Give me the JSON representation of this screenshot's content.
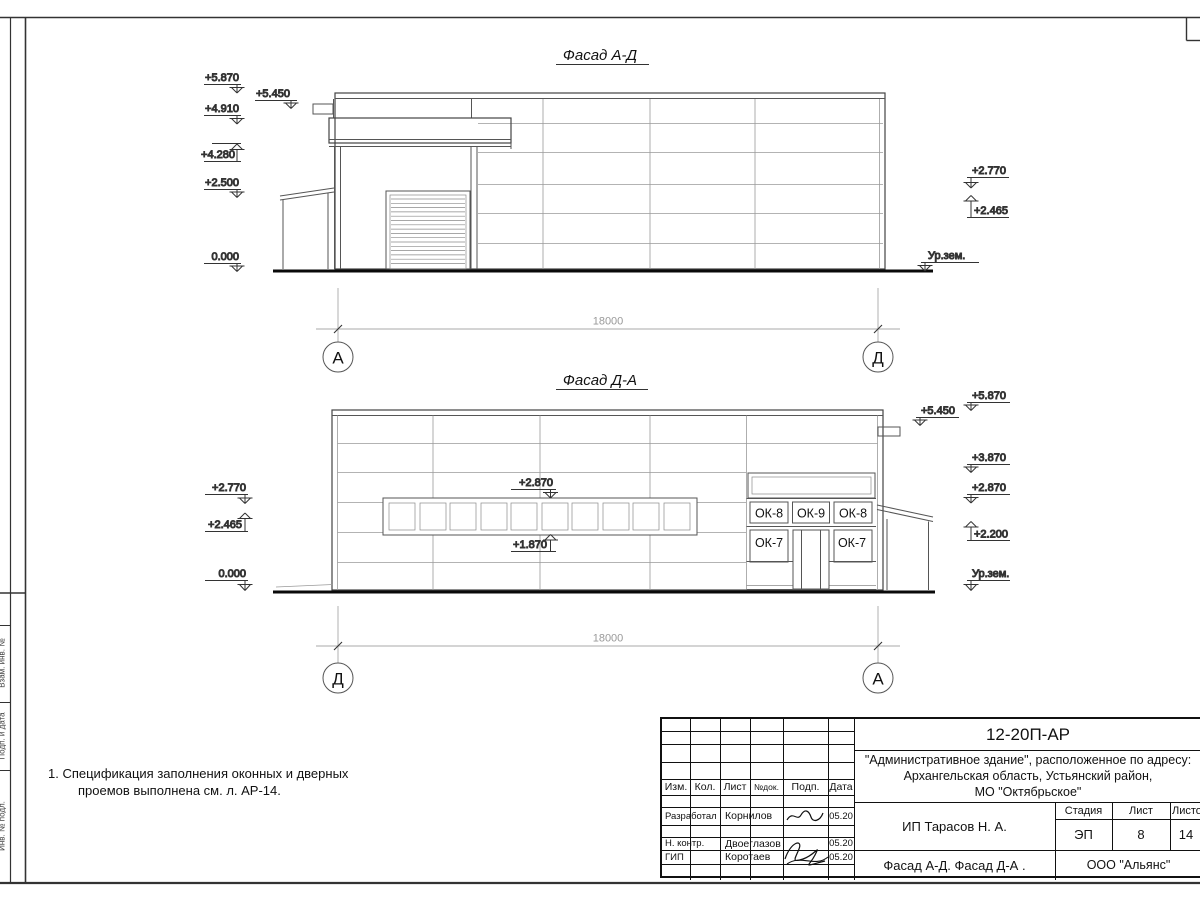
{
  "frame": {
    "side_labels": {
      "l1": "Взам. инв. №",
      "l2": "Подп. и дата",
      "l3": "Инв. № подл."
    }
  },
  "facade1": {
    "title": "Фасад А-Д",
    "marks": {
      "m5870": "+5.870",
      "m4910": "+4.910",
      "m4280": "+4.280",
      "m2500": "+2.500",
      "m0000": "0.000",
      "m5450": "+5.450",
      "m2770": "+2.770",
      "m2465": "+2.465",
      "ground": "Ур.зем."
    },
    "dim": "18000",
    "axis_left": "А",
    "axis_right": "Д"
  },
  "facade2": {
    "title": "Фасад Д-А",
    "marks": {
      "m5870": "+5.870",
      "m5450": "+5.450",
      "m3870": "+3.870",
      "m2870r": "+2.870",
      "m2200": "+2.200",
      "m2770": "+2.770",
      "m2465": "+2.465",
      "m0000": "0.000",
      "band_top": "+2.870",
      "band_bottom": "+1.870",
      "ground": "Ур.зем."
    },
    "windows": {
      "ok8a": "ОК-8",
      "ok9": "ОК-9",
      "ok8b": "ОК-8",
      "ok7a": "ОК-7",
      "ok7b": "ОК-7"
    },
    "dim": "18000",
    "axis_left": "Д",
    "axis_right": "А"
  },
  "note": {
    "line1": "1. Спецификация заполнения оконных и дверных",
    "line2": "проемов выполнена см. л. АР-14."
  },
  "titleblock": {
    "code": "12-20П-АР",
    "project": {
      "line1": "\"Административное здание\", расположенное по адресу:",
      "line2": "Архангельская область, Устьянский район,",
      "line3": "МО \"Октябрьское\""
    },
    "headers": {
      "izm": "Изм.",
      "kol": "Кол.",
      "list": "Лист",
      "ndoc": "№док.",
      "podp": "Подп.",
      "data": "Дата"
    },
    "rows": [
      {
        "role": "Разработал",
        "name": "Корнилов",
        "date": "05.20"
      },
      {
        "role": "Н. контр.",
        "name": "Двоеглазов",
        "date": "05.20"
      },
      {
        "role": "ГИП",
        "name": "Коротаев",
        "date": "05.20"
      }
    ],
    "client": "ИП Тарасов Н. А.",
    "stage": {
      "label": "Стадия",
      "value": "ЭП"
    },
    "sheet": {
      "label": "Лист",
      "value": "8"
    },
    "sheets": {
      "label": "Листов",
      "value": "14"
    },
    "sheet_title": "Фасад А-Д. Фасад Д-А .",
    "org": "ООО \"Альянс\""
  }
}
